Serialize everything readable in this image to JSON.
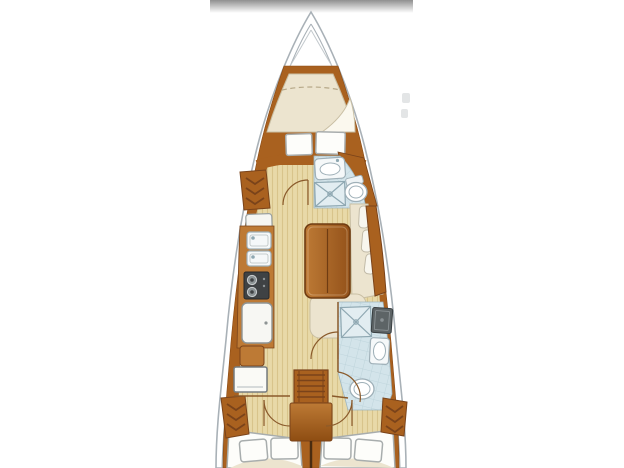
{
  "canvas": {
    "width": 624,
    "height": 468
  },
  "scene": {
    "type": "sailboat-interior-floor-plan",
    "label": "Top-down interior layout plan of a sailing yacht, bow up",
    "orientation": "bow-up",
    "visible_text": "none"
  },
  "colors": {
    "background": "#ffffff",
    "top_bar_start": "#8f8f8f",
    "top_bar_end": "#ffffff",
    "hull_fill": "#ffffff",
    "hull_outline": "#a9b1b7",
    "wood": "#a9611f",
    "wood_light": "#bd7a35",
    "wood_dark": "#7a431a",
    "floor": "#e8d9a8",
    "floor_stripe": "#d8c48b",
    "upholstery": "#ece4cf",
    "upholstery_line": "#c9bfa4",
    "linen_white": "#fdfdfa",
    "outline_gray": "#a8adad",
    "bath_tile": "#d3e4ea",
    "bath_tile_line": "#b9d0d8",
    "fixture_white": "#f5f8f9",
    "fixture_line": "#9fb0b8",
    "stove_dark": "#3f4244",
    "burner_gray": "#8d9496",
    "counter_gray": "#5d6466",
    "door_arc": "#8a5a2b",
    "table_dark": "#6f3c12"
  },
  "areas": [
    {
      "name": "anchor-locker",
      "features": [
        "locker-outline"
      ]
    },
    {
      "name": "forward-cabin",
      "features": [
        "v-berth",
        "pillow-stitch-line",
        "folded-sheet",
        "seat-locker-left",
        "seat-locker-right",
        "hanging-locker",
        "cabin-door"
      ]
    },
    {
      "name": "forward-head",
      "features": [
        "sink-counter",
        "shower-grate",
        "toilet",
        "tile-floor"
      ]
    },
    {
      "name": "galley",
      "features": [
        "counter",
        "top-locker",
        "double-sink-upper",
        "double-sink-lower",
        "two-burner-stove",
        "refrigerator"
      ]
    },
    {
      "name": "salon",
      "features": [
        "dining-table",
        "l-settee",
        "aft-settee",
        "settee-back-cushions",
        "sideboard"
      ]
    },
    {
      "name": "navigation-station",
      "features": [
        "nav-seat",
        "chart-table"
      ]
    },
    {
      "name": "aft-head",
      "features": [
        "shower-grate",
        "vanity-counter",
        "sink",
        "toilet",
        "tile-floor",
        "doors"
      ]
    },
    {
      "name": "companionway",
      "features": [
        "ladder-steps",
        "engine-box"
      ]
    },
    {
      "name": "aft-cabin-port",
      "features": [
        "double-berth",
        "pillows",
        "hanging-locker",
        "cabin-door"
      ]
    },
    {
      "name": "aft-cabin-starboard",
      "features": [
        "double-berth",
        "pillows",
        "hanging-locker",
        "cabin-door"
      ]
    }
  ]
}
